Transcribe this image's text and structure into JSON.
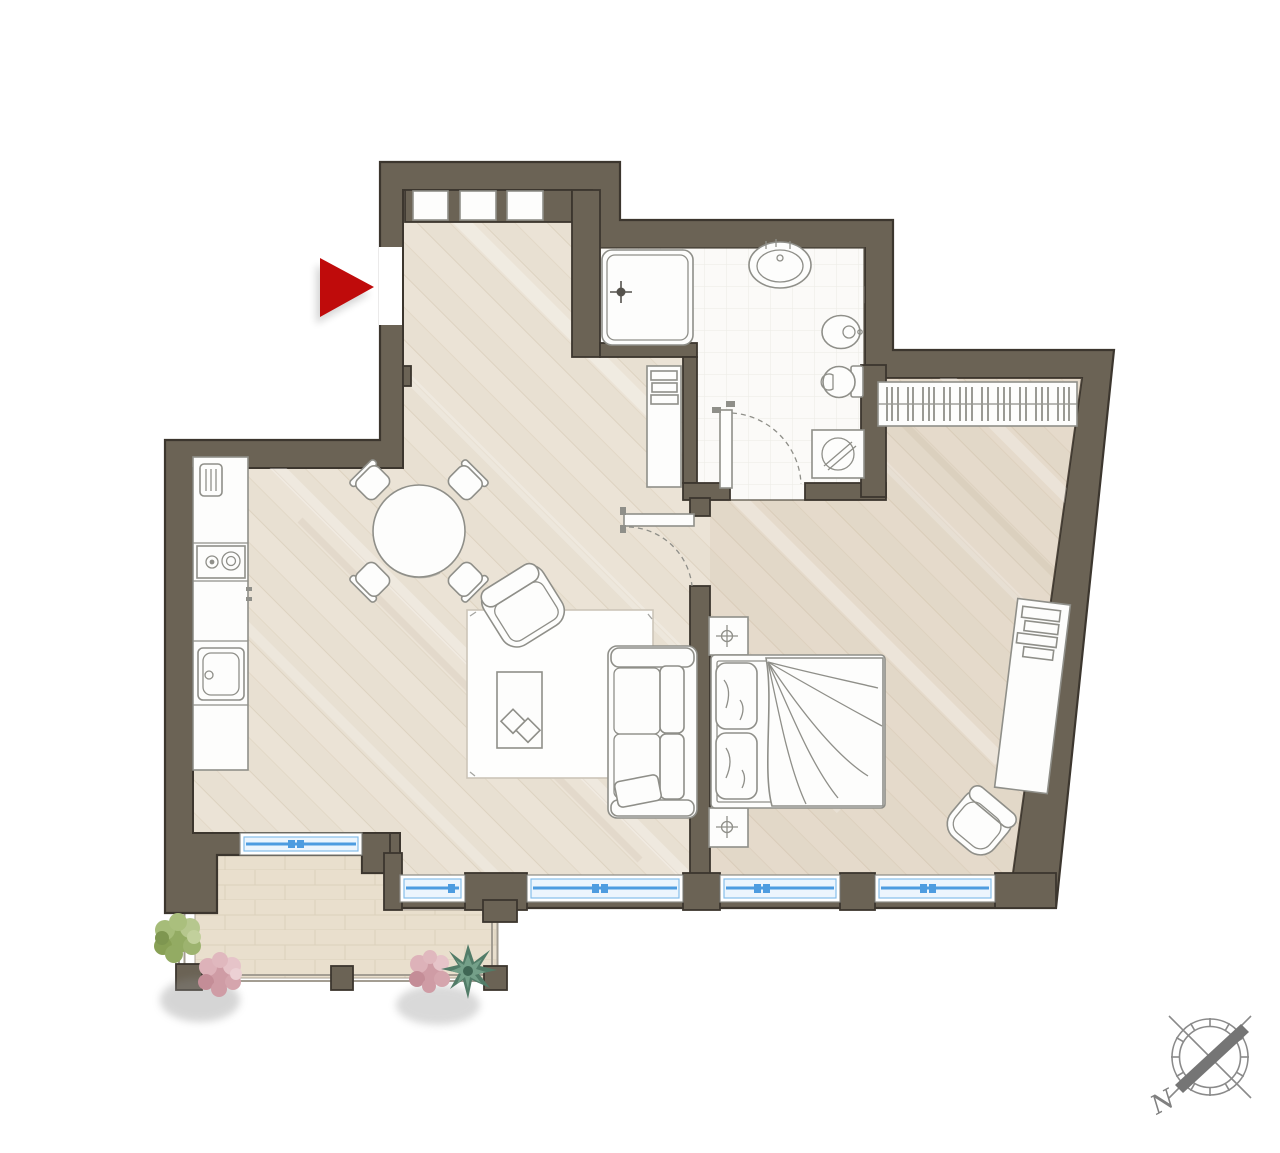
{
  "plan": {
    "type": "apartment-floor-plan",
    "compass": {
      "label": "N",
      "icon": "compass-rose-icon"
    },
    "entrance": {
      "icon": "entrance-arrow-icon",
      "direction": "right"
    },
    "colors": {
      "wall": "#6b6355",
      "wall_outline": "#3c362e",
      "floor_wood": "#ebe3d6",
      "floor_tile": "#fbfaf8",
      "floor_balcony": "#e9dfcd",
      "window_glass": "#4d9ce0",
      "entrance_arrow": "#bf0b0b",
      "furniture_stroke": "#8f8f89",
      "plant_green": "#9db36f",
      "plant_pink": "#d5a5ad",
      "plant_teal": "#527c68",
      "compass_gray": "#8a8a8a"
    },
    "rooms": [
      {
        "name": "living-dining-kitchen",
        "furniture": [
          "entrance-closet-modules",
          "kitchen-counter",
          "small-appliance",
          "cooktop",
          "kitchen-sink",
          "dining-table",
          "dining-chair",
          "dining-chair",
          "dining-chair",
          "dining-chair",
          "rug",
          "lounge-armchair",
          "coffee-table",
          "books",
          "sofa",
          "sofa-pillow",
          "shelf-cabinet"
        ]
      },
      {
        "name": "bathroom",
        "furniture": [
          "shower",
          "washbasin",
          "bidet",
          "toilet",
          "washing-machine",
          "bathroom-door"
        ]
      },
      {
        "name": "bedroom",
        "furniture": [
          "wardrobe-with-hangers",
          "double-bed",
          "pillows",
          "blanket",
          "nightstand-with-lamp",
          "nightstand-with-lamp",
          "desk-console",
          "books",
          "bedroom-armchair",
          "bedroom-door"
        ]
      },
      {
        "name": "balcony",
        "furniture": [
          "railing",
          "green-bush-plant",
          "pink-flower-plant",
          "pink-flower-plant",
          "teal-succulent-plant"
        ]
      }
    ],
    "window_count": 5,
    "door_count": 3
  }
}
